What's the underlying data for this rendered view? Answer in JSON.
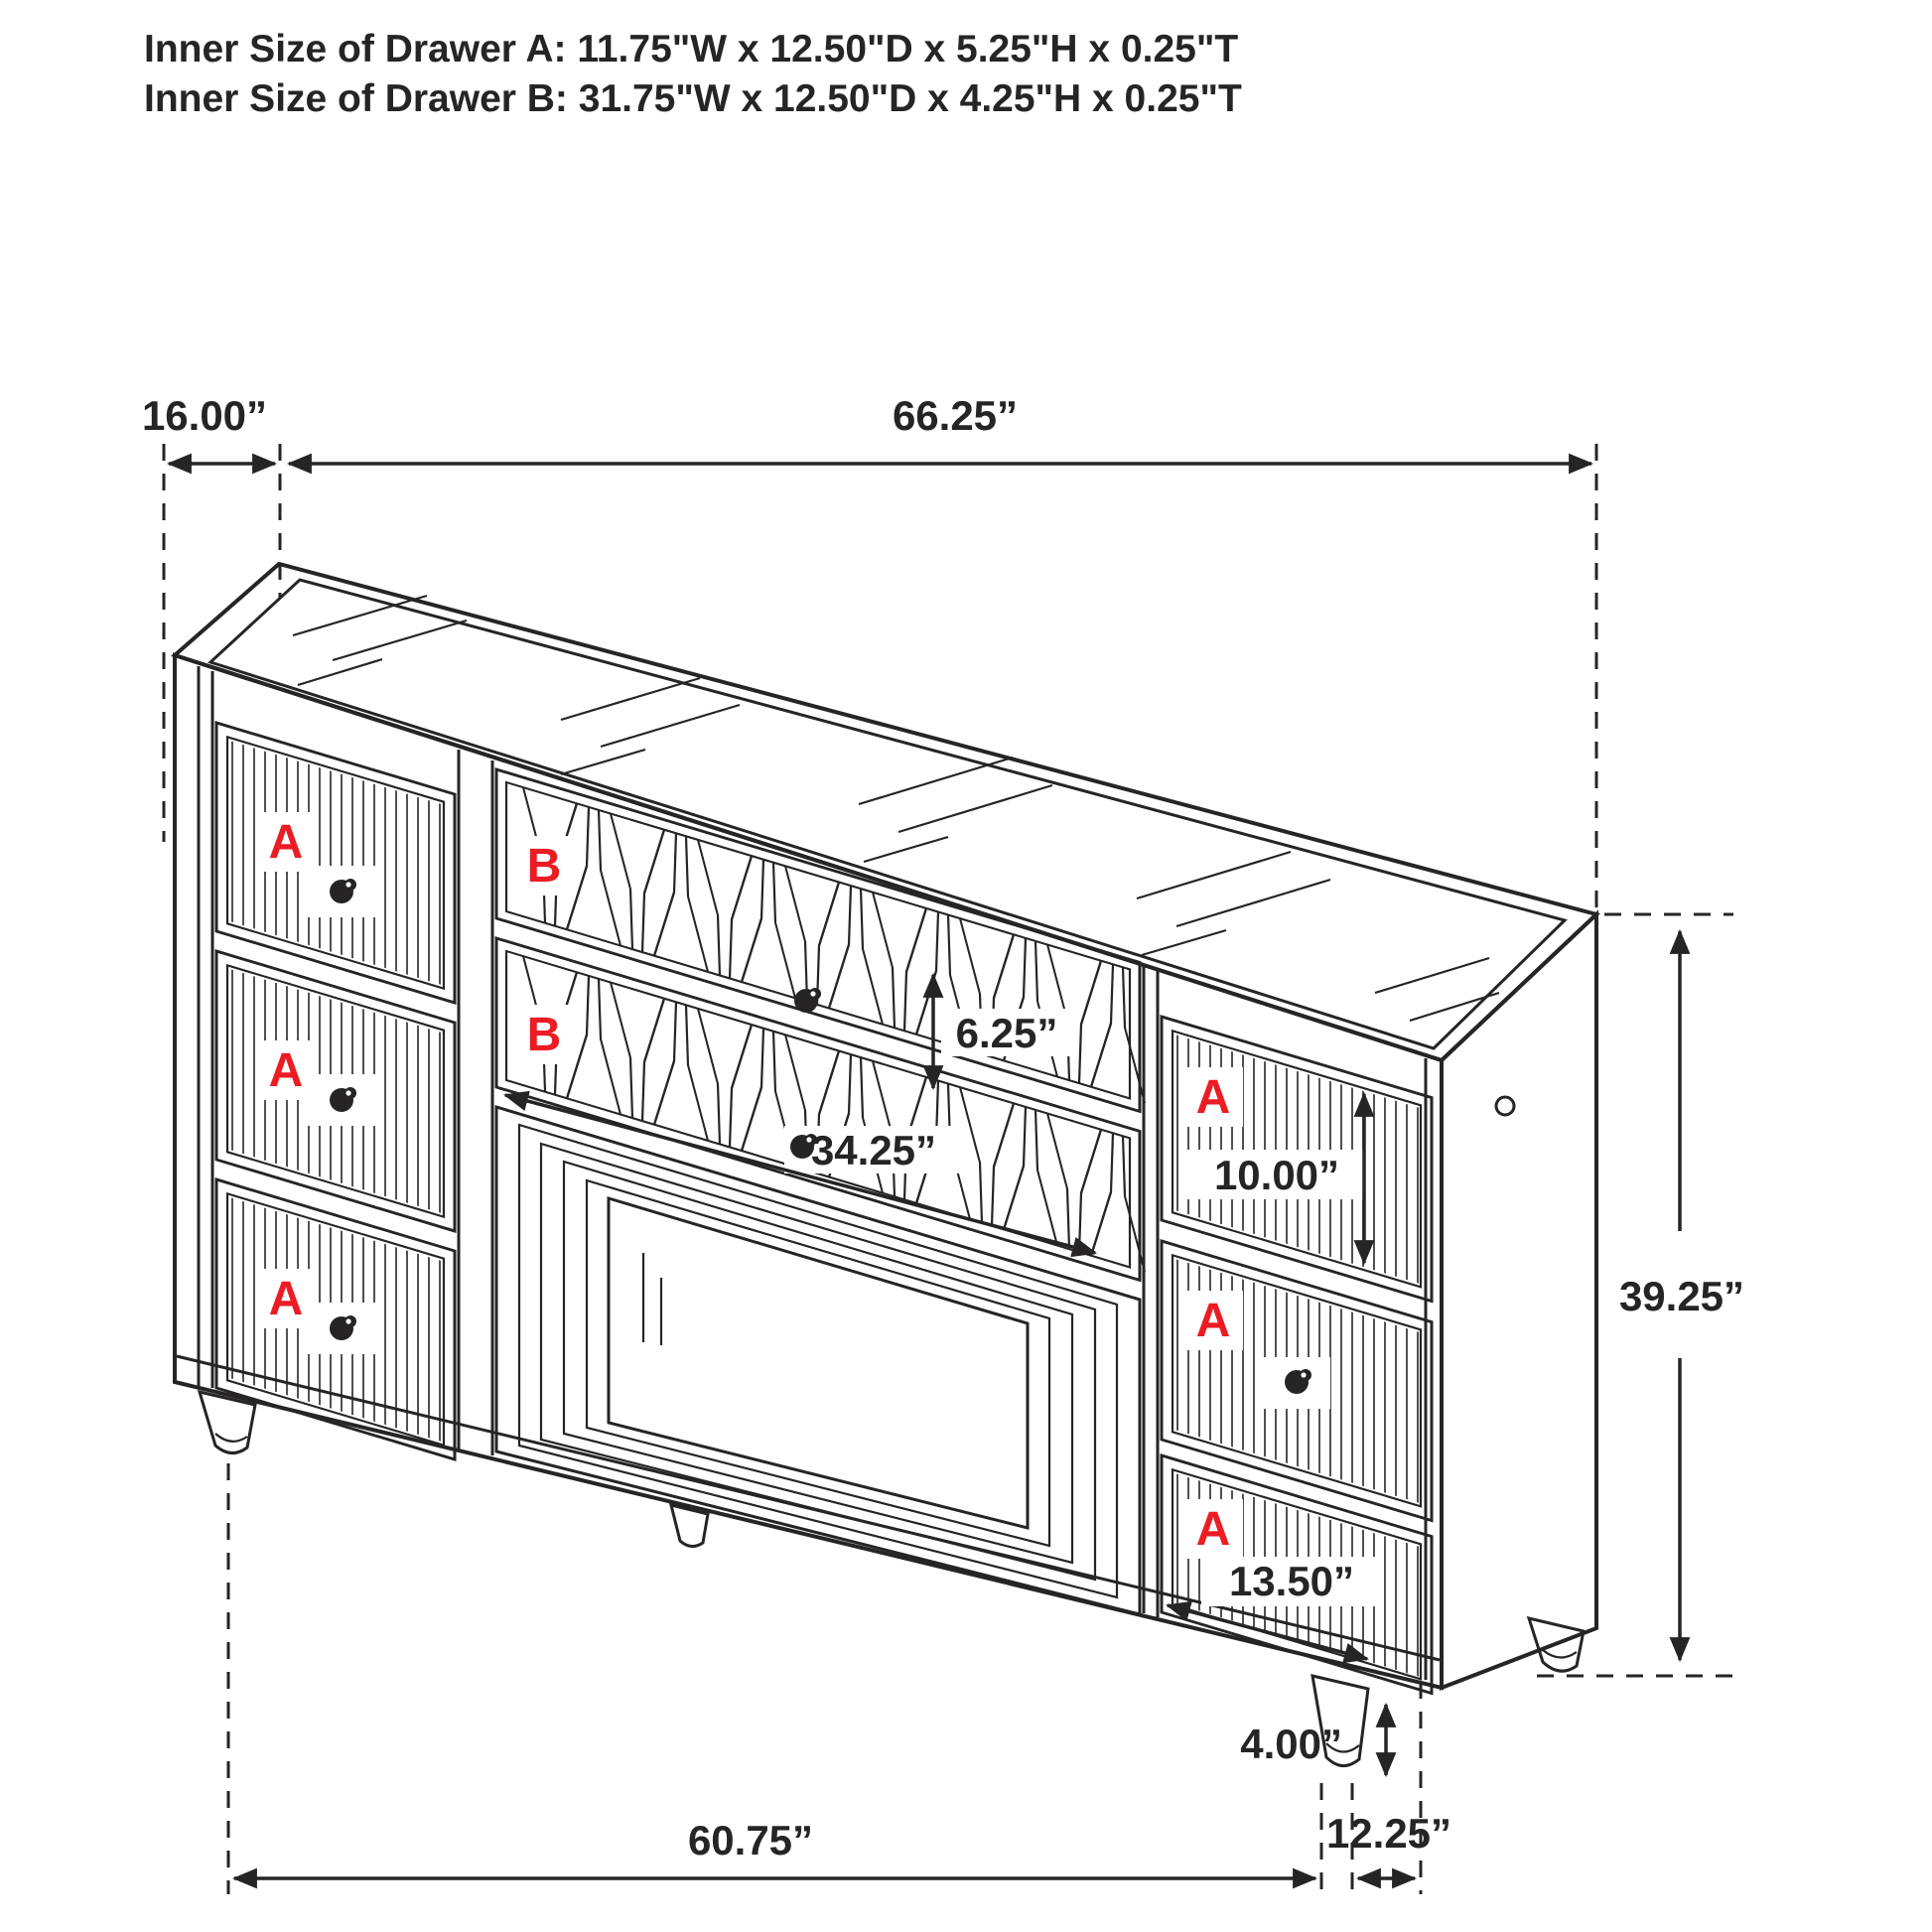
{
  "title": {
    "line1": "Inner Size of Drawer A: 11.75\"W x 12.50\"D x 5.25\"H x 0.25\"T",
    "line2": "Inner Size of Drawer B: 31.75\"W x 12.50\"D x 4.25\"H x 0.25\"T"
  },
  "drawer_labels": {
    "a": "A",
    "b": "B"
  },
  "dimensions": {
    "top_depth": "16.00”",
    "top_width": "66.25”",
    "b_drawer_height": "6.25”",
    "b_drawer_width": "34.25”",
    "right_top_drawer_height": "10.00”",
    "overall_height": "39.25”",
    "right_bottom_drawer_width": "13.50”",
    "leg_height": "4.00”",
    "bottom_width": "60.75”",
    "bottom_depth": "12.25”"
  },
  "colors": {
    "line": "#272425",
    "label_red": "#ec1c24",
    "background": "#ffffff"
  }
}
